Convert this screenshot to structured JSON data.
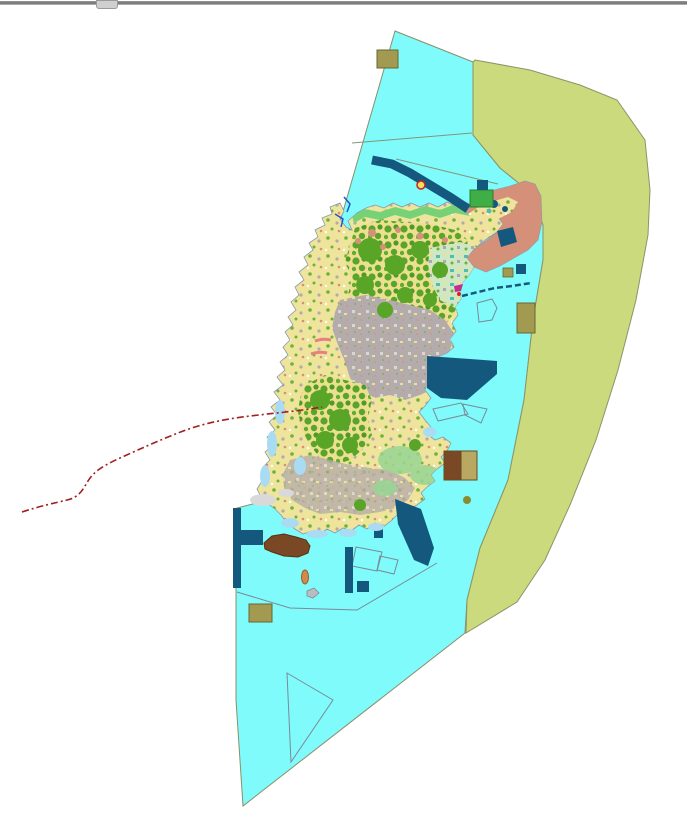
{
  "window": {
    "splitter": {
      "name": "top-splitter-bar"
    }
  },
  "map": {
    "kind": "gis-landuse-map",
    "palette": {
      "background": "#ffffff",
      "water": "#7ffbfb",
      "water_border": "#87906a",
      "offshore_zone": "#cbda7c",
      "offshore_border": "#8a9468",
      "land_base": "#efe49c",
      "coast_stroke": "#8a99a8",
      "forest": "#58a528",
      "forest_dark": "#4f9c22",
      "urban": "#b4acac",
      "pale_mosaic": "#cfe7c2",
      "teal": "#54bcae",
      "salmon": "#d49078",
      "navy": "#15587e",
      "khaki": "#a29a50",
      "khaki_border": "#6a6430",
      "brown": "#7a4824",
      "tan": "#b8a862",
      "coastal_blue": "#a9dcf2",
      "coast_green": "#77d277",
      "bright_green": "#00a018",
      "pale_gray": "#d9d9d9",
      "red_line": "#a02020",
      "pink_beach": "#e88080",
      "stream_blue": "#2255cc",
      "boundary_gray": "#7a8a99",
      "thin_line": "#85957a",
      "orange_boat": "#d08a50",
      "magenta": "#c03090",
      "green_parcel": "#3fae46"
    },
    "features": {
      "water_area": "water",
      "offshore_zone_area": "offshore_zone",
      "island_landmass": "land_base",
      "salmon_zone_ne": "salmon",
      "harbor_band_north": "navy",
      "port_area_east": "navy",
      "navy_band_se": "navy",
      "breakwater_sw": "navy",
      "red_boundary_line": "red_line",
      "khaki_parcels": "khaki",
      "brown_dredge_area": "brown"
    }
  }
}
